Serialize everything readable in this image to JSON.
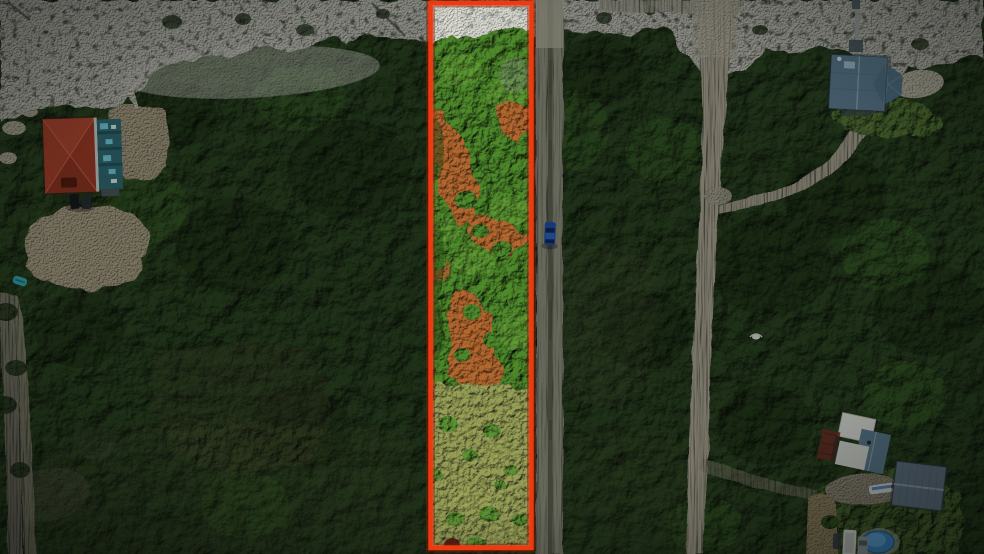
{
  "photo": {
    "kind": "aerial-lot-listing-photo",
    "scene_elements": [
      "sand-dune-beach-strip",
      "coastal-forest",
      "highlighted-vacant-lot",
      "red-property-boundary",
      "gravel-street",
      "sandy-street",
      "side-road",
      "red-roof-house",
      "teal-house-wing",
      "blue-roof-house",
      "beach-boardwalk",
      "white-roof-house",
      "gray-roof-outbuilding",
      "swimming-pool",
      "parked-vehicles",
      "blue-car-on-road",
      "orange-dirt-trails",
      "driveway-clearings",
      "shell-sand-patch",
      "teal-kayak",
      "white-bird"
    ]
  },
  "colors": {
    "forest": "#2a4420",
    "dune_sand": "#c8c8be",
    "parcel_sand": "#d9dad1",
    "parcel_canopy": "#4e8a2b",
    "parcel_grass": "#99a158",
    "dirt": "#b4682f",
    "gravel_road": "#8c8c7c",
    "sandy_road": "#b2ab99",
    "left_road": "#7b7a6c",
    "red_roof": "#a83c28",
    "teal_siding": "#2f6b76",
    "blue_roof": "#5f7f96",
    "white_roof": "#e6e7e3",
    "gray_roof": "#66798b",
    "pool": "#3f8fd4",
    "lawn": "#587c37",
    "shell_patch": "#cfc9b8",
    "car_blue": "#1d4fae",
    "white_vehicle": "#e4e7e4",
    "boundary": "#ee3a10",
    "boundary_glow": "#8a1a02"
  }
}
